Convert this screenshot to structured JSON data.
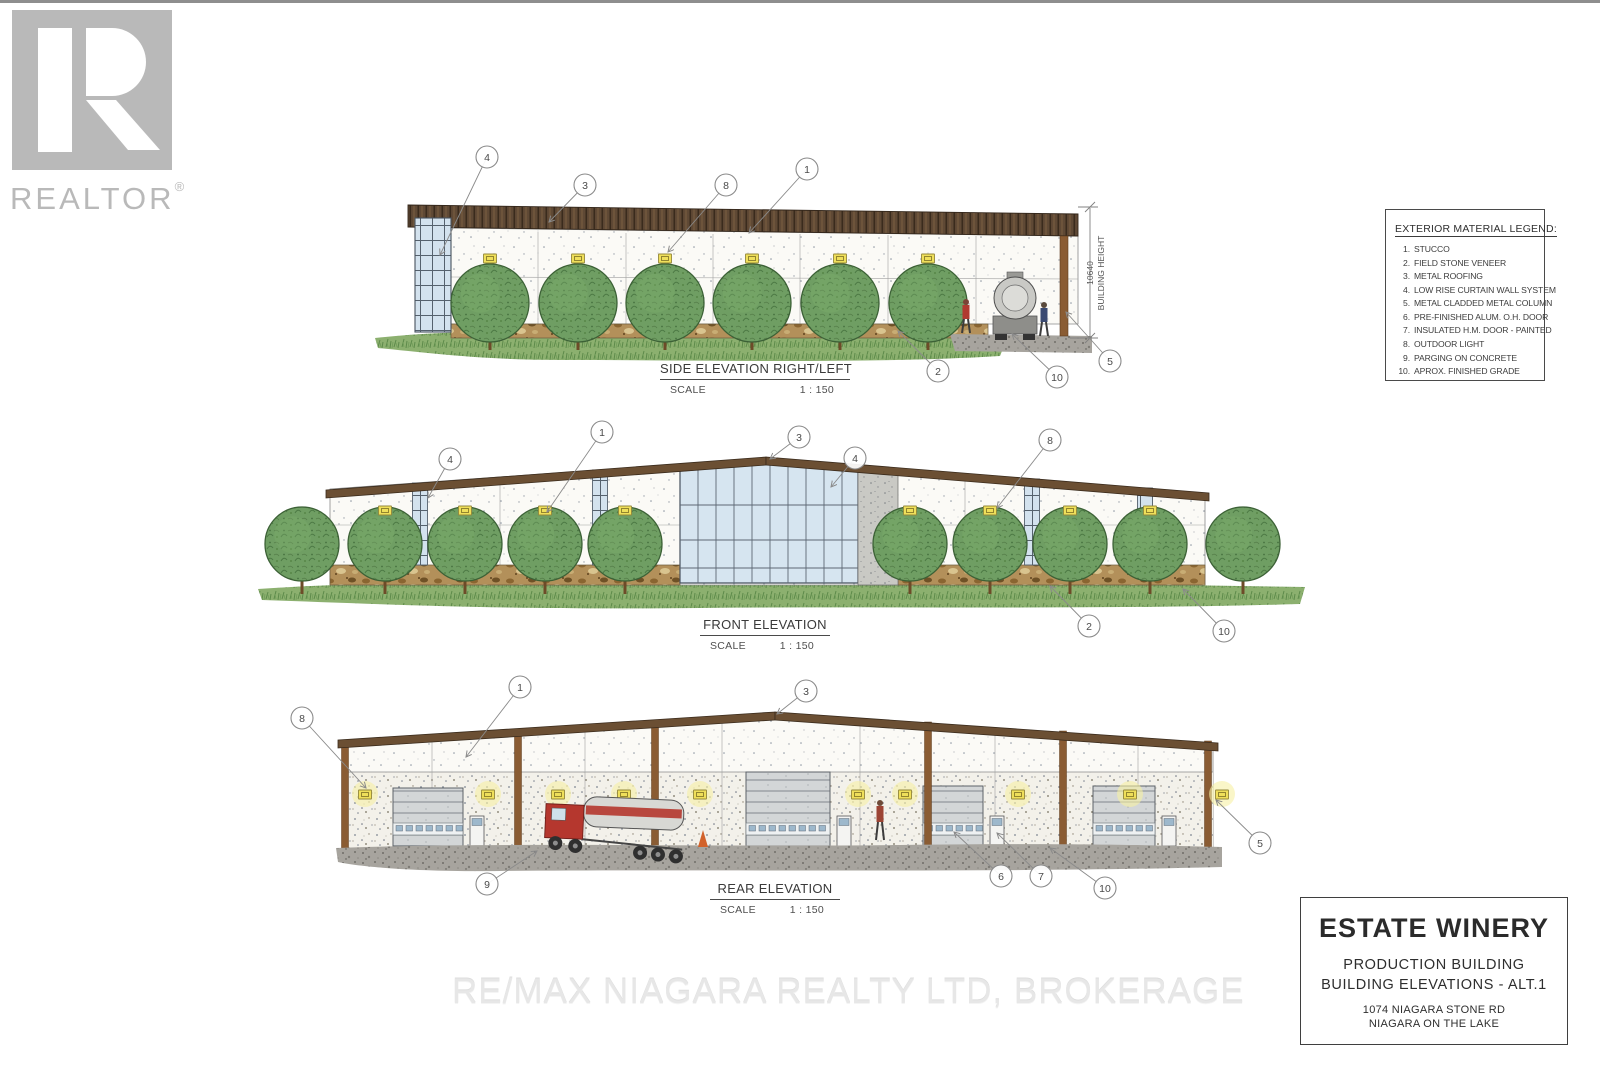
{
  "branding": {
    "logo_text": "REALTOR",
    "registered": "®"
  },
  "watermark": {
    "text": "RE/MAX NIAGARA REALTY LTD, BROKERAGE"
  },
  "legend": {
    "title": "EXTERIOR MATERIAL LEGEND:",
    "items": [
      {
        "num": "1.",
        "label": "STUCCO"
      },
      {
        "num": "2.",
        "label": "FIELD STONE VENEER"
      },
      {
        "num": "3.",
        "label": "METAL ROOFING"
      },
      {
        "num": "4.",
        "label": "LOW RISE CURTAIN WALL SYSTEM"
      },
      {
        "num": "5.",
        "label": "METAL CLADDED METAL COLUMN"
      },
      {
        "num": "6.",
        "label": "PRE-FINISHED ALUM. O.H. DOOR"
      },
      {
        "num": "7.",
        "label": "INSULATED H.M. DOOR - PAINTED"
      },
      {
        "num": "8.",
        "label": "OUTDOOR LIGHT"
      },
      {
        "num": "9.",
        "label": "PARGING ON CONCRETE"
      },
      {
        "num": "10.",
        "label": "APROX. FINISHED GRADE"
      }
    ]
  },
  "elevations": {
    "side": {
      "title": "SIDE ELEVATION RIGHT/LEFT",
      "scale_label": "SCALE",
      "scale_value": "1 : 150",
      "callouts": [
        "4",
        "3",
        "8",
        "1",
        "2",
        "10",
        "5"
      ],
      "dimension": {
        "value": "10640",
        "label": "BUILDING HEIGHT"
      }
    },
    "front": {
      "title": "FRONT ELEVATION",
      "scale_label": "SCALE",
      "scale_value": "1 : 150",
      "callouts": [
        "4",
        "1",
        "3",
        "4",
        "8",
        "2",
        "10"
      ]
    },
    "rear": {
      "title": "REAR ELEVATION",
      "scale_label": "SCALE",
      "scale_value": "1 : 150",
      "callouts": [
        "8",
        "1",
        "3",
        "9",
        "6",
        "7",
        "10",
        "5"
      ]
    }
  },
  "title_block": {
    "project": "ESTATE WINERY",
    "line1": "PRODUCTION BUILDING",
    "line2": "BUILDING ELEVATIONS - ALT.1",
    "address1": "1074 NIAGARA STONE RD",
    "address2": "NIAGARA ON THE LAKE"
  },
  "colors": {
    "roof_brown": "#5f4935",
    "stone_tan": "#b3905a",
    "tree_green": "#6f9e63",
    "glass_blue": "#d3e2ee",
    "light_yellow": "#efdf5a",
    "grass_green": "#8cb06f",
    "column_brown": "#8a5c33",
    "logo_gray": "#b9b9b9"
  }
}
